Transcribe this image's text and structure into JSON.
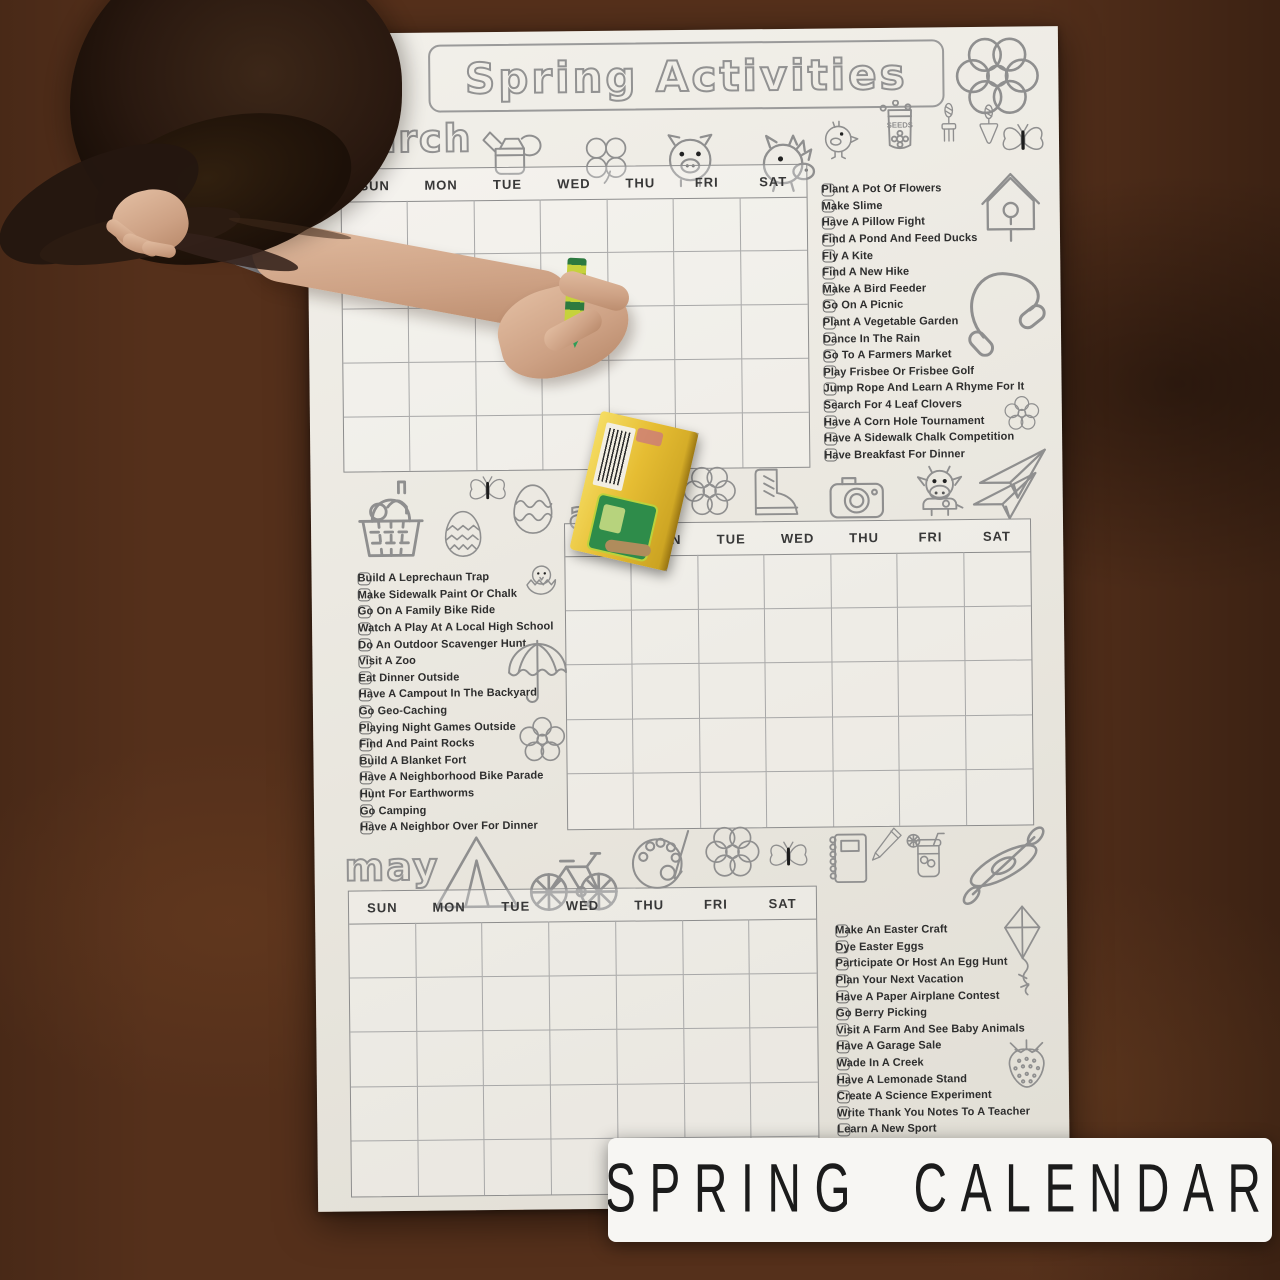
{
  "banner": {
    "title": "Spring Activities",
    "product_label": "SPRING CALENDAR"
  },
  "calendar": {
    "day_headers": [
      "SUN",
      "MON",
      "TUE",
      "WED",
      "THU",
      "FRI",
      "SAT"
    ]
  },
  "months": {
    "march": {
      "label": "march"
    },
    "april": {
      "label": "april"
    },
    "may": {
      "label": "may"
    }
  },
  "checklists": {
    "top_right": [
      "Plant A Pot Of Flowers",
      "Make Slime",
      "Have A Pillow Fight",
      "Find A Pond And Feed Ducks",
      "Fly A Kite",
      "Find A New Hike",
      "Make A Bird Feeder",
      "Go On A Picnic",
      "Plant A Vegetable Garden",
      "Dance In The Rain",
      "Go To A Farmers Market",
      "Play Frisbee Or Frisbee Golf",
      "Jump Rope And Learn A Rhyme For It",
      "Search For 4 Leaf Clovers",
      "Have A Corn Hole Tournament",
      "Have A Sidewalk Chalk Competition",
      "Have Breakfast For Dinner"
    ],
    "middle_left": [
      "Build A Leprechaun Trap",
      "Make Sidewalk Paint Or Chalk",
      "Go On A Family Bike Ride",
      "Watch A Play At A Local High School",
      "Do An Outdoor Scavenger Hunt",
      "Visit A Zoo",
      "Eat Dinner Outside",
      "Have A Campout In The Backyard",
      "Go Geo-Caching",
      "Playing Night Games Outside",
      "Find And Paint Rocks",
      "Build A Blanket Fort",
      "Have A Neighborhood Bike Parade",
      "Hunt For Earthworms",
      "Go Camping",
      "Have A Neighbor Over For Dinner"
    ],
    "bottom_right": [
      "Make An Easter Craft",
      "Dye Easter Eggs",
      "Participate Or Host An Egg Hunt",
      "Plan Your Next Vacation",
      "Have A Paper Airplane Contest",
      "Go Berry Picking",
      "Visit A Farm And See Baby Animals",
      "Have A Garage Sale",
      "Wade In A Creek",
      "Have A Lemonade Stand",
      "Create A Science Experiment",
      "Write Thank You Notes To A Teacher",
      "Learn A New Sport"
    ]
  },
  "icons": {
    "seeds_packet_label": "SEEDS",
    "title_row": [
      "flower"
    ],
    "march_row": [
      "watering-can",
      "four-leaf-clover",
      "pig",
      "horse"
    ],
    "march_right_column": [
      "chick",
      "seeds-packet",
      "garden-fork",
      "trowel",
      "butterfly",
      "birdhouse",
      "jump-rope",
      "flower",
      "paper-airplane"
    ],
    "middle_band_left": [
      "picnic-basket",
      "butterfly",
      "easter-egg-zigzag",
      "easter-egg-wavy",
      "hatching-chick"
    ],
    "middle_band_right": [
      "flower",
      "boot",
      "camera",
      "cow",
      "paper-airplane"
    ],
    "april_left_column": [
      "umbrella",
      "flower"
    ],
    "may_row": [
      "tent",
      "bicycle",
      "paint-palette",
      "flower",
      "butterfly",
      "notebook",
      "pencil",
      "mason-jar-drink",
      "kayak"
    ],
    "may_right_column": [
      "kite",
      "strawberry"
    ]
  },
  "theme": {
    "ink": "#929292",
    "paper": "#ecebe5",
    "text": "#2e2e2e",
    "banner": "#f7f6f3",
    "wood": "#4a2815",
    "crayon-green": "#2f9e57",
    "box-yellow": "#e6bd33"
  }
}
